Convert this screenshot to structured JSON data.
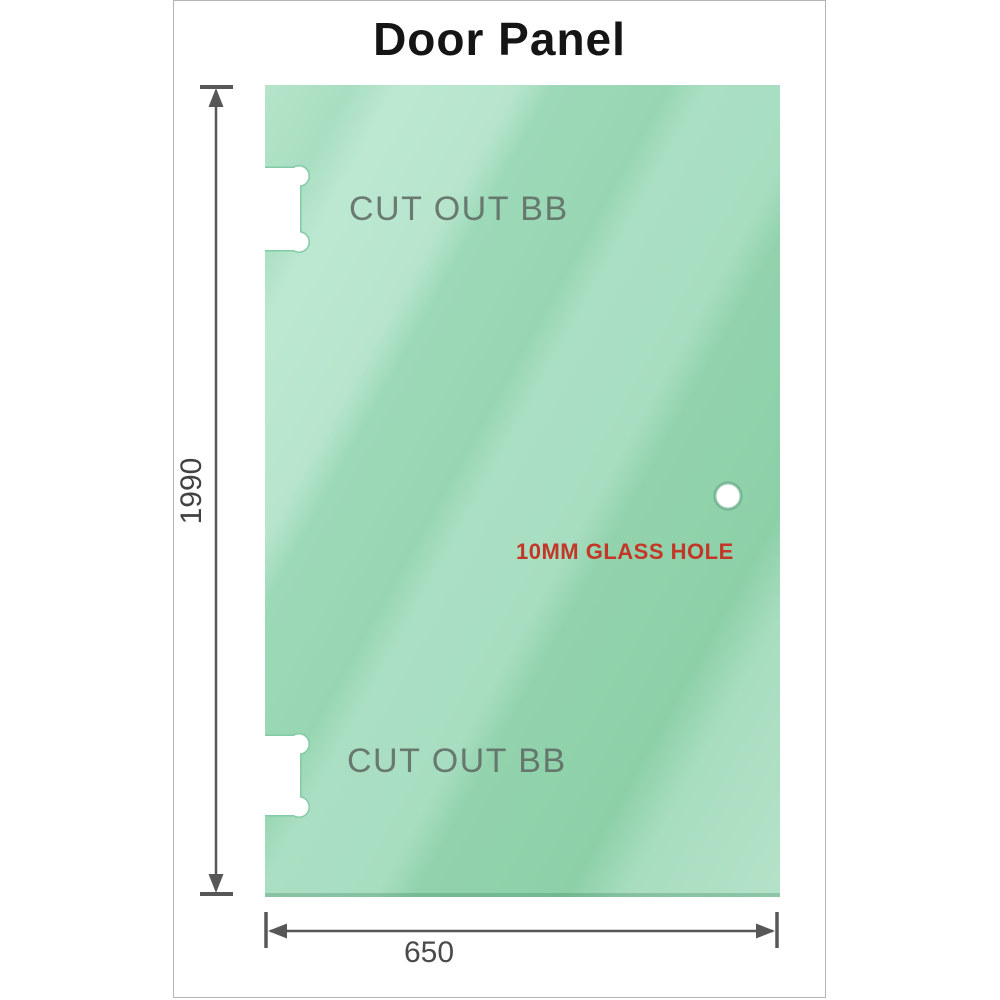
{
  "diagram": {
    "title": "Door Panel",
    "panel": {
      "height_mm": "1990",
      "width_mm": "650",
      "cutout_top_label": "CUT OUT BB",
      "cutout_bottom_label": "CUT OUT BB",
      "glass_hole_label": "10MM GLASS HOLE"
    },
    "colors": {
      "glass_green_light": "#bce8d1",
      "glass_green_mid": "#9cd9b8",
      "glass_green_dark": "#8dd0a8",
      "dimension_gray": "#575757",
      "cutout_label_gray": "#606b64",
      "annotation_red": "#c23727",
      "card_border_gray": "#b5b5b5"
    }
  }
}
